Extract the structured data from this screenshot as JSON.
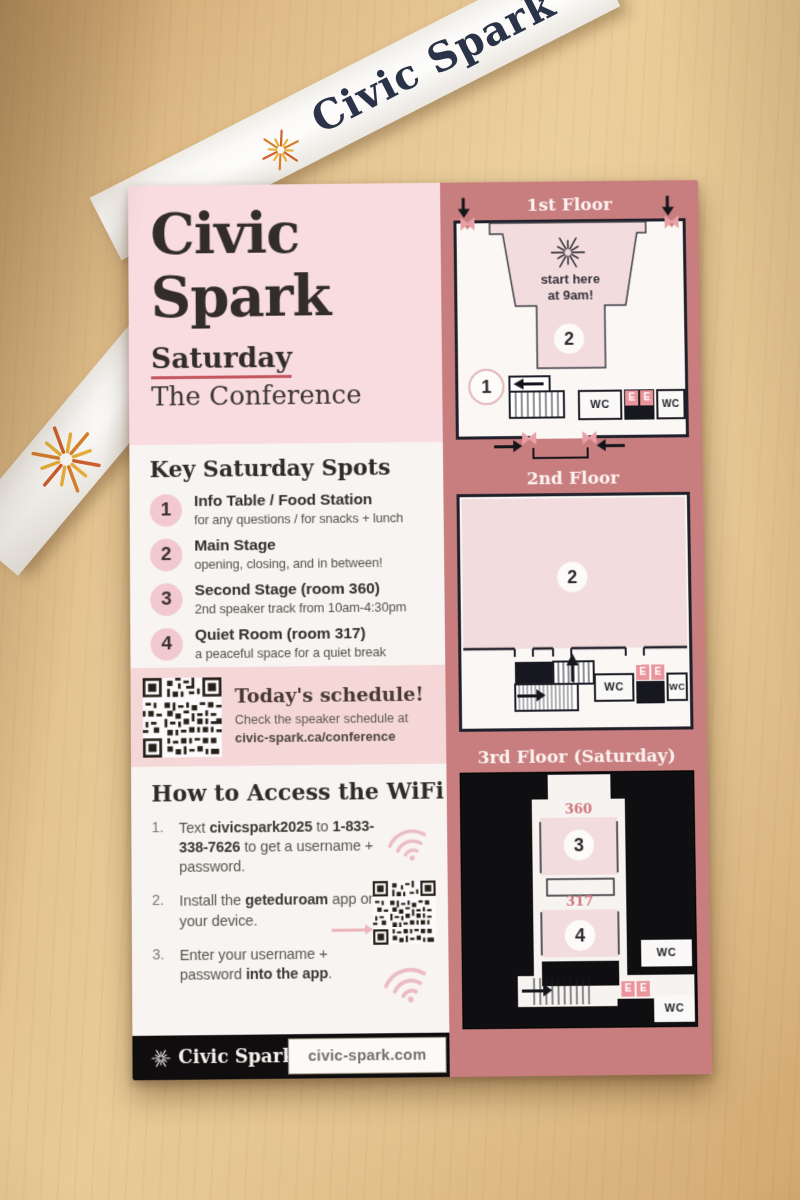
{
  "lanyard": {
    "brand": "Civic Spark",
    "brand_partial": "Civi"
  },
  "card": {
    "header": {
      "title_line1": "Civic",
      "title_line2": "Spark",
      "day": "Saturday",
      "subtitle": "The Conference"
    },
    "spots": {
      "heading": "Key Saturday Spots",
      "items": [
        {
          "num": "1",
          "title": "Info Table / Food Station",
          "desc": "for any questions / for snacks + lunch"
        },
        {
          "num": "2",
          "title": "Main Stage",
          "desc": "opening, closing, and in between!"
        },
        {
          "num": "3",
          "title": "Second Stage (room 360)",
          "desc": "2nd speaker track from 10am-4:30pm"
        },
        {
          "num": "4",
          "title": "Quiet Room (room 317)",
          "desc": "a peaceful space for a quiet break"
        }
      ]
    },
    "schedule": {
      "heading": "Today's schedule!",
      "line1": "Check the speaker schedule at",
      "line2": "civic-spark.ca/conference"
    },
    "wifi": {
      "heading": "How to Access the WiFi",
      "steps": {
        "s1": {
          "num": "1.",
          "t1": "Text ",
          "b1": "civicspark2025",
          "t2": " to ",
          "b2": "1-833-338-7626",
          "t3": " to get a username + password."
        },
        "s2": {
          "num": "2.",
          "t1": "Install the ",
          "b1": "geteduroam",
          "t2": " app on your device."
        },
        "s3": {
          "num": "3.",
          "t1": "Enter your username + password ",
          "b1": "into the app",
          "t2": "."
        }
      }
    },
    "footer": {
      "brand": "Civic Spark",
      "url": "civic-spark.com"
    }
  },
  "floors": {
    "f1": {
      "label": "1st Floor",
      "start_line1": "start here",
      "start_line2": "at 9am!",
      "main_stage_num": "2",
      "info_table_num": "1",
      "wc": "WC",
      "elevator": "E"
    },
    "f2": {
      "label": "2nd Floor",
      "main_stage_num": "2",
      "wc": "WC",
      "elevator": "E"
    },
    "f3": {
      "label": "3rd Floor (Saturday)",
      "room_360": "360",
      "second_stage_num": "3",
      "room_317": "317",
      "quiet_room_num": "4",
      "wc": "WC",
      "elevator": "E"
    }
  },
  "colors": {
    "salmon_panel": "#c87e7e",
    "blush_header": "#f8dce0",
    "qr_band": "#f5d7d8",
    "underline_red": "#c4575e",
    "lanyard_navy": "#2b3349",
    "circle_pink": "#f2c9ce",
    "elevator_pink": "#ea949b",
    "wood": "#e2c08a",
    "footer_black": "#100d0e"
  }
}
